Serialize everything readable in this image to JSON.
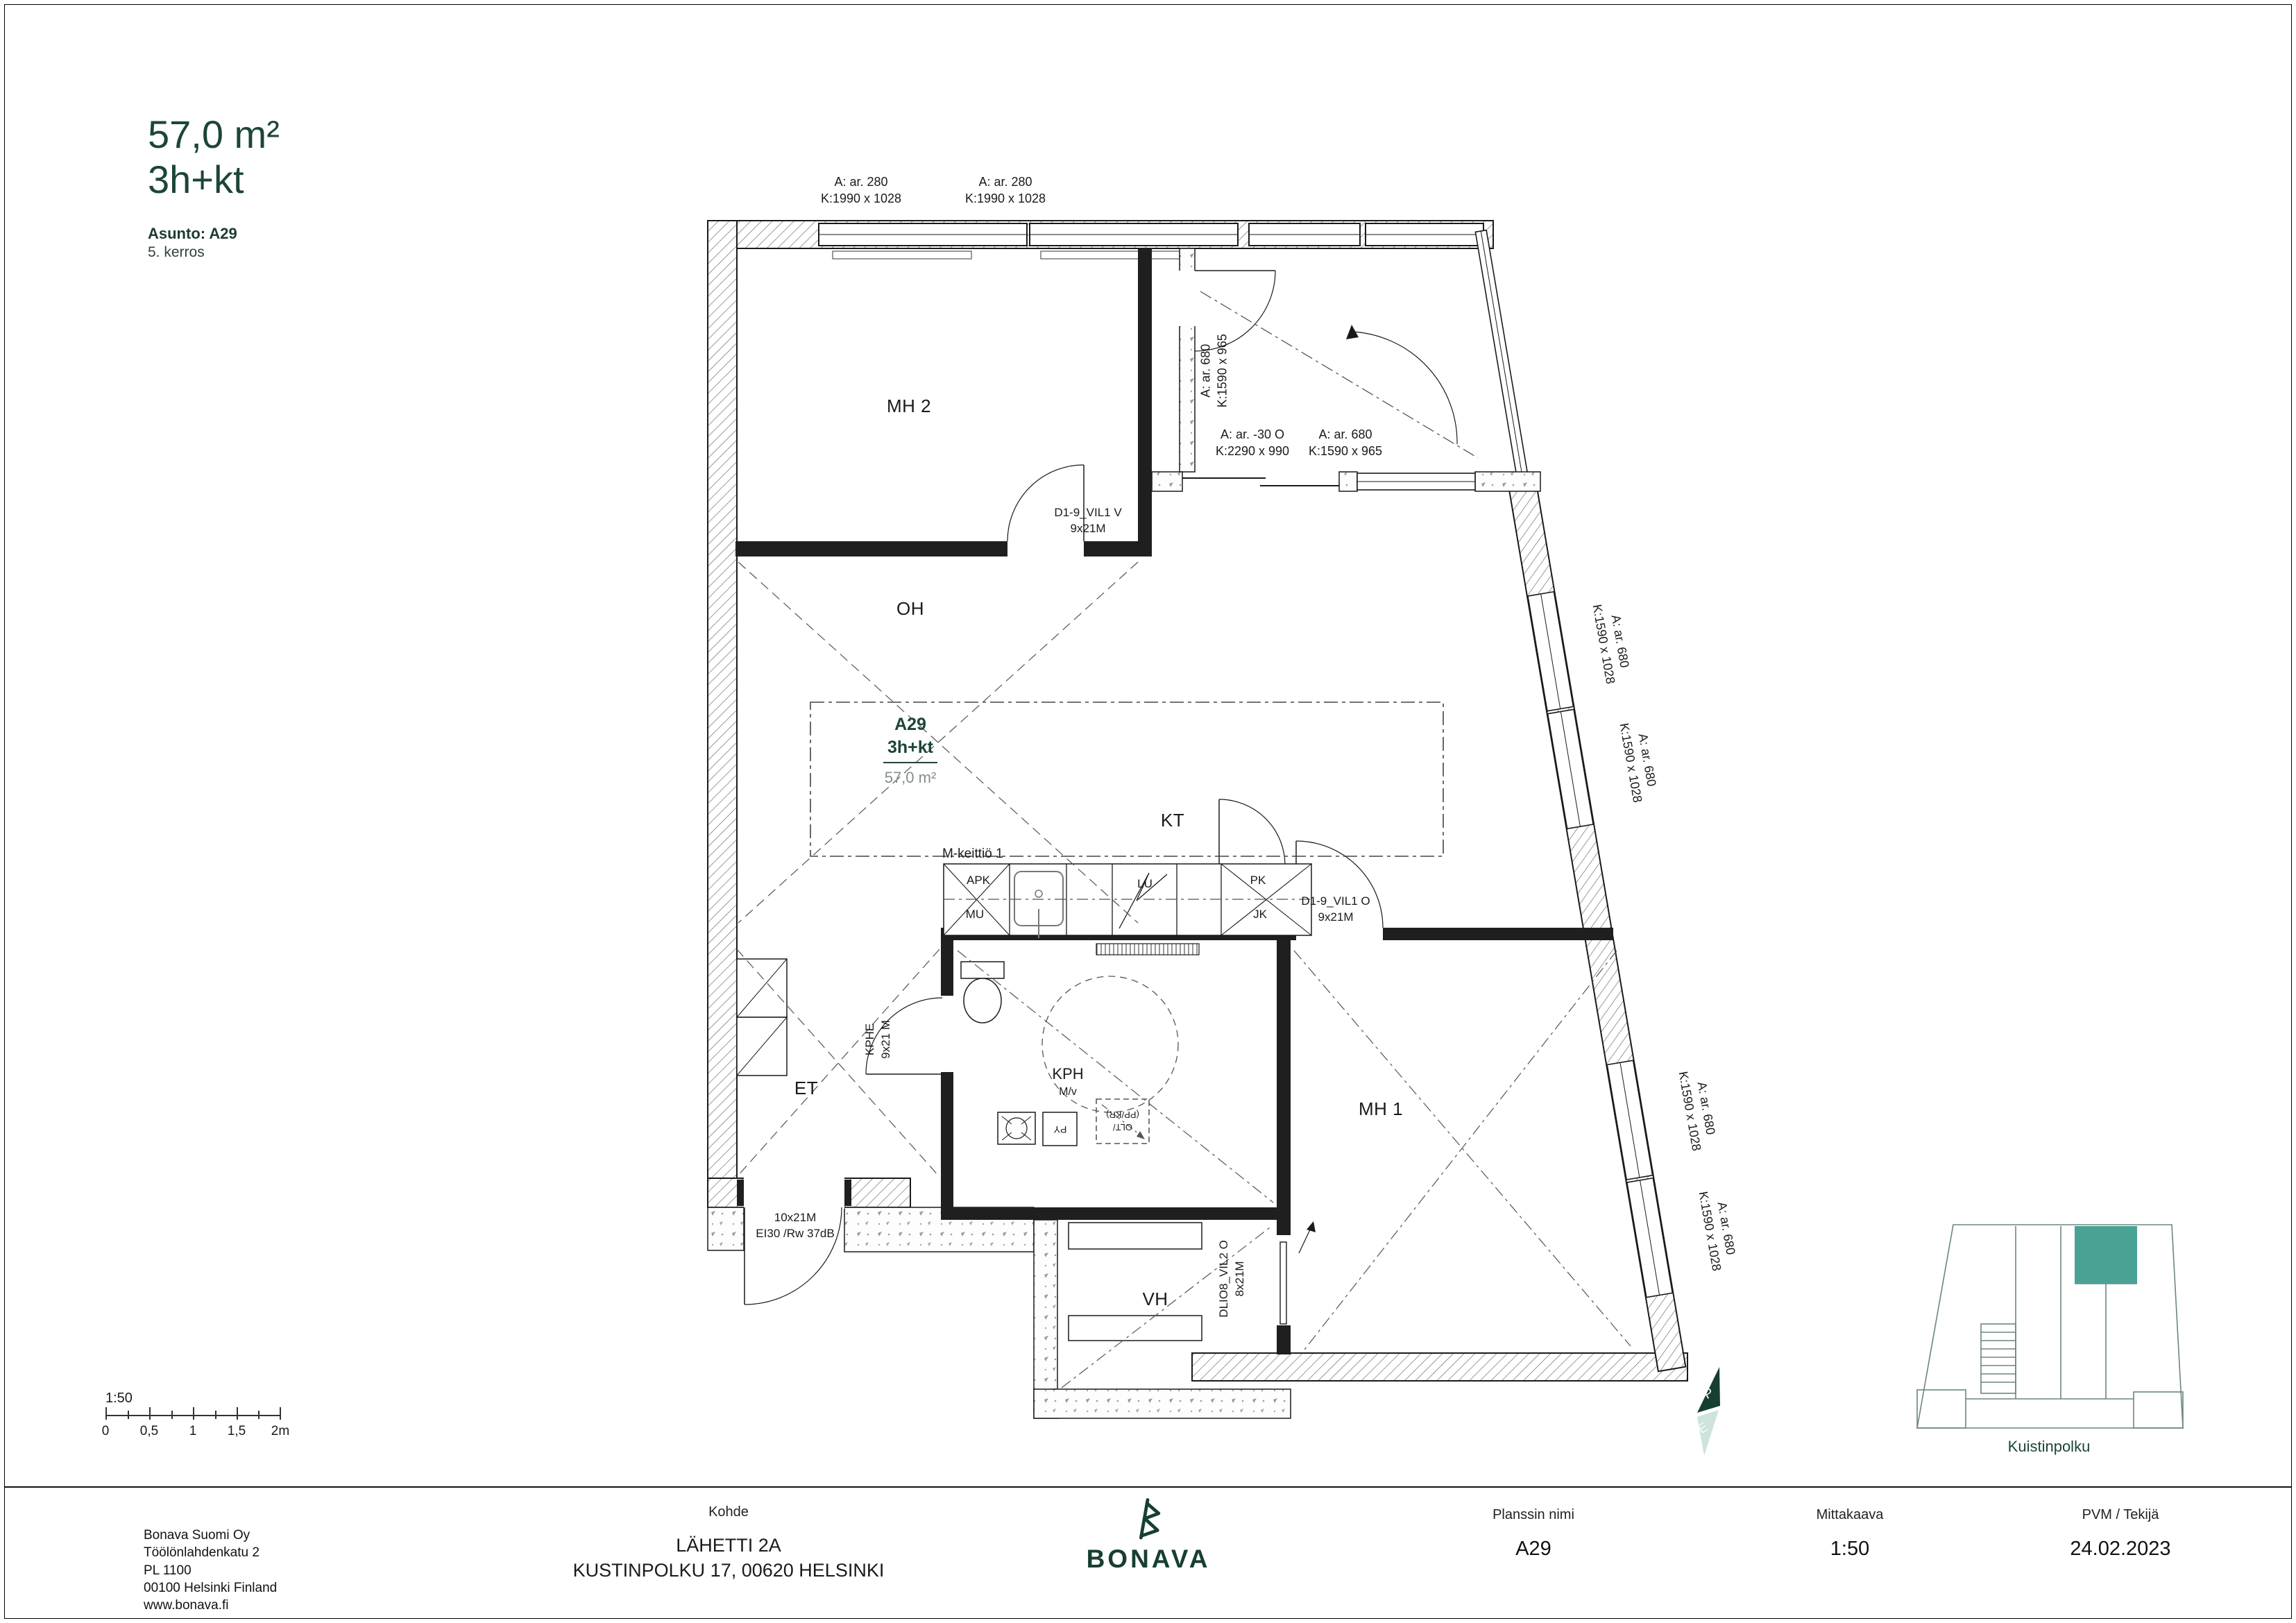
{
  "header": {
    "area": "57,0 m²",
    "type": "3h+kt",
    "apartment": "Asunto: A29",
    "floor": "5. kerros"
  },
  "plan": {
    "unit": {
      "id": "A29",
      "type": "3h+kt",
      "area": "57,0 m²"
    },
    "rooms": {
      "mh2": "MH 2",
      "oh": "OH",
      "kt": "KT",
      "et": "ET",
      "kph": "KPH",
      "kph_sub": "M/v",
      "mh1": "MH 1",
      "vh": "VH"
    },
    "kitchen": {
      "title": "M-keittiö 1",
      "apk": "APK",
      "mu": "MU",
      "lu": "LU",
      "pk": "PK",
      "jk": "JK"
    },
    "fixtures": {
      "py": "PY",
      "olt_line1": "OLT/",
      "olt_line2": "(PP/KR)"
    },
    "doors": {
      "mh2_door": {
        "l1": "D1-9_VIL1 V",
        "l2": "9x21M"
      },
      "mh1_door": {
        "l1": "D1-9_VIL1 O",
        "l2": "9x21M"
      },
      "kph_door": {
        "l1": "KPHE",
        "l2": "9x21 M"
      },
      "vh_door": {
        "l1": "DLIO8_VIL2 O",
        "l2": "8x21M"
      },
      "entry_door": {
        "l1": "10x21M",
        "l2": "EI30 /Rw 37dB"
      }
    },
    "windows": {
      "top1": {
        "a": "A: ar. 280",
        "k": "K:1990 x 1028"
      },
      "top2": {
        "a": "A: ar. 280",
        "k": "K:1990 x 1028"
      },
      "balcony_side": {
        "a": "A: ar. 680",
        "k": "K:1590 x 965"
      },
      "balcony_door": {
        "a": "A: ar. -30  O",
        "k": "K:2290 x 990"
      },
      "balcony_win": {
        "a": "A: ar. 680",
        "k": "K:1590 x 965"
      },
      "right1": {
        "a": "A: ar. 680",
        "k": "K:1590 x 1028"
      },
      "right2": {
        "a": "A: ar. 680",
        "k": "K:1590 x 1028"
      },
      "right3": {
        "a": "A: ar. 680",
        "k": "K:1590 x 1028"
      },
      "right4": {
        "a": "A: ar. 680",
        "k": "K:1590 x 1028"
      }
    }
  },
  "scalebar": {
    "ratio": "1:50",
    "ticks": [
      "0",
      "0,5",
      "1",
      "1,5",
      "2m"
    ]
  },
  "compass": {
    "north": "P",
    "south": "E"
  },
  "sitemap": {
    "street": "Kuistinpolku",
    "highlight_color": "#4AA294"
  },
  "footer": {
    "company": [
      "Bonava Suomi Oy",
      "Töölönlahdenkatu 2",
      "PL 1100",
      "00100 Helsinki Finland",
      "www.bonava.fi"
    ],
    "kohde_label": "Kohde",
    "kohde_line1": "LÄHETTI 2A",
    "kohde_line2": "KUSTINPOLKU 17, 00620 HELSINKI",
    "logo": "BONAVA",
    "col1_label": "Planssin nimi",
    "col1_value": "A29",
    "col2_label": "Mittakaava",
    "col2_value": "1:50",
    "col3_label": "PVM / Tekijä",
    "col3_value": "24.02.2023"
  }
}
